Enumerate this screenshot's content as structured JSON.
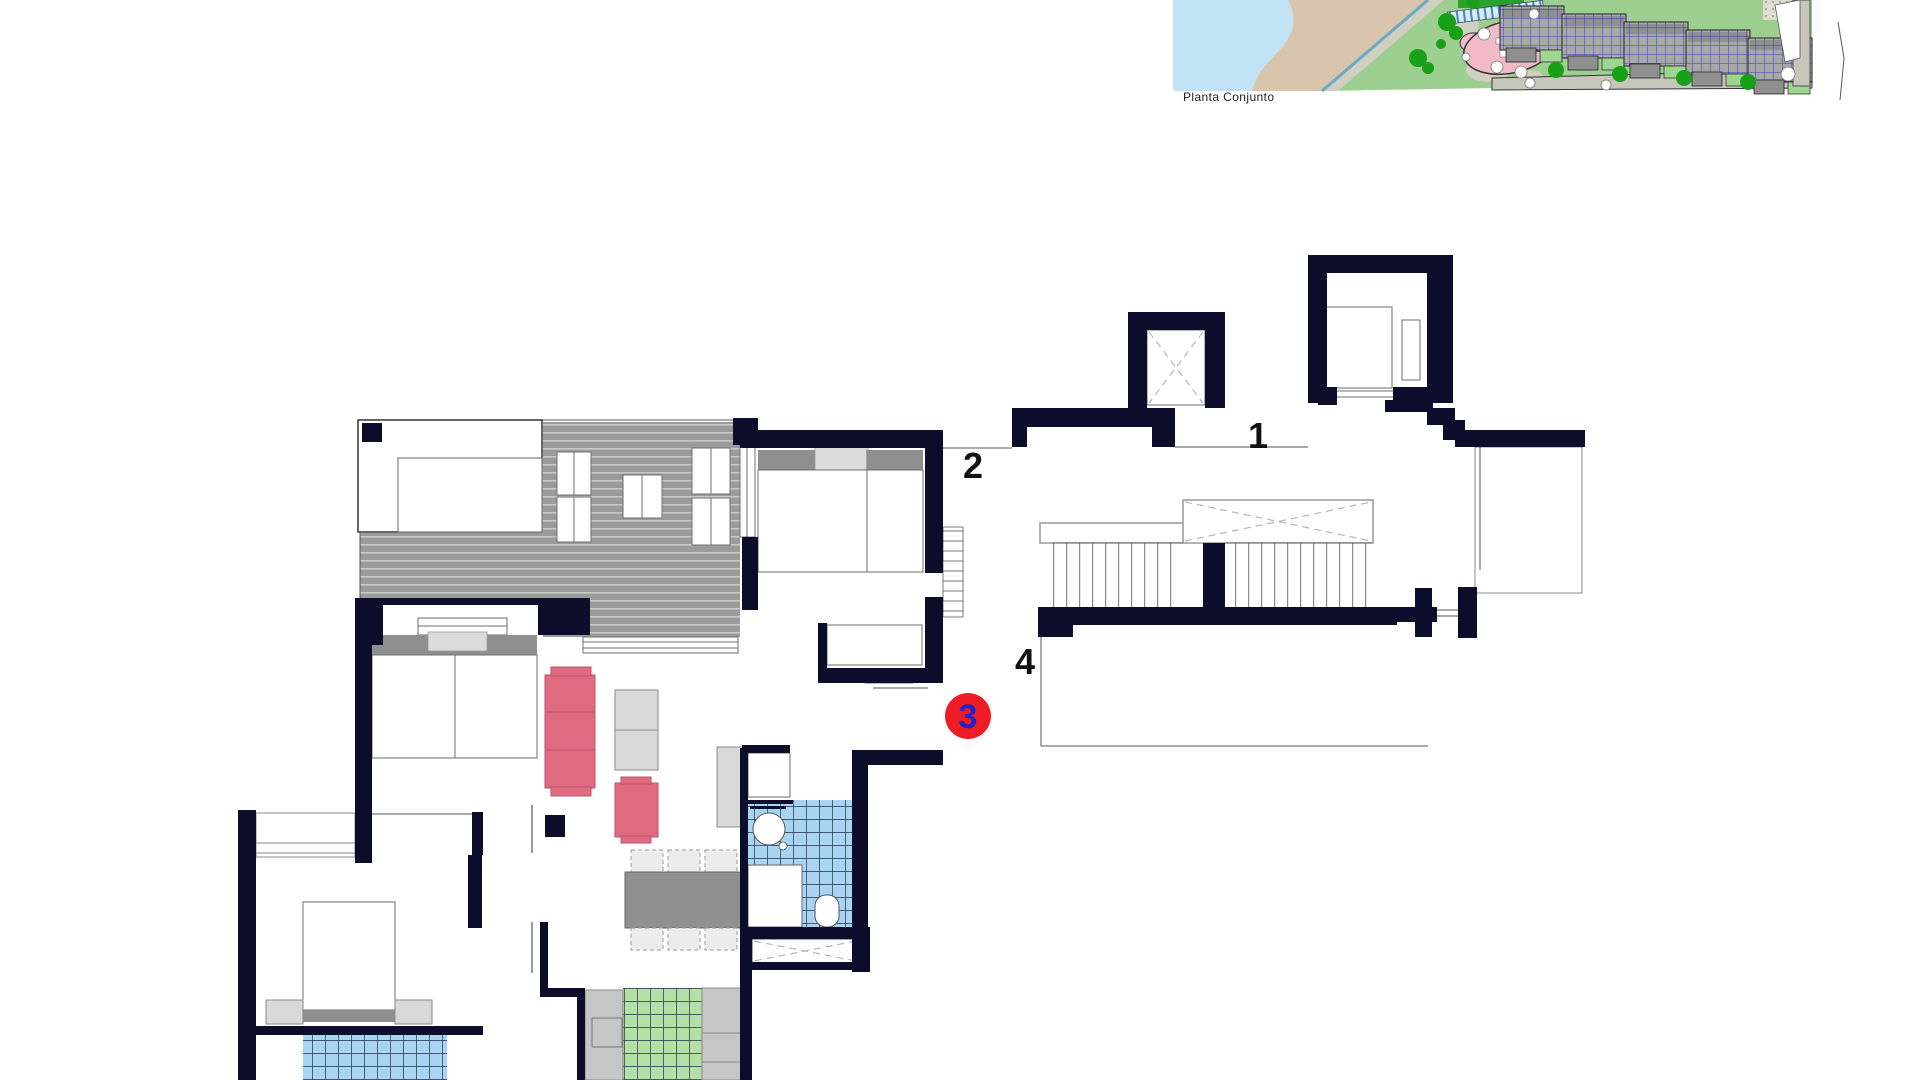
{
  "site_plan": {
    "caption": "Planta Conjunto"
  },
  "floor_plan": {
    "unit_labels": {
      "label_1": "1",
      "label_2": "2",
      "label_4": "4"
    },
    "selected_unit": {
      "label": "3"
    }
  },
  "colors": {
    "wall": "#0d0d2b",
    "line": "#55565e",
    "deck_base": "#9b9b9b",
    "deck_stripe": "#c9c9c9",
    "tile_blue": "#a8d4f2",
    "tile_green": "#b4dfa6",
    "tile_grid": "#26324a",
    "furniture_pink": "#e06a80",
    "furniture_gray": "#8f8f8f",
    "badge_red": "#ee1c24",
    "badge_number_blue": "#2222cc",
    "label_black": "#111111",
    "water": "#c2e3f6",
    "sand": "#d9c5ae",
    "lawn": "#9ccf90",
    "path_gray": "#cfcfc2",
    "tree_green": "#18a018",
    "pool_pink": "#f2bac7",
    "pool_blue": "#a9d9ef",
    "building_gray": "#a8a8a8",
    "building_line_blue": "#2b35c8",
    "road_gray": "#c6c6ba"
  }
}
